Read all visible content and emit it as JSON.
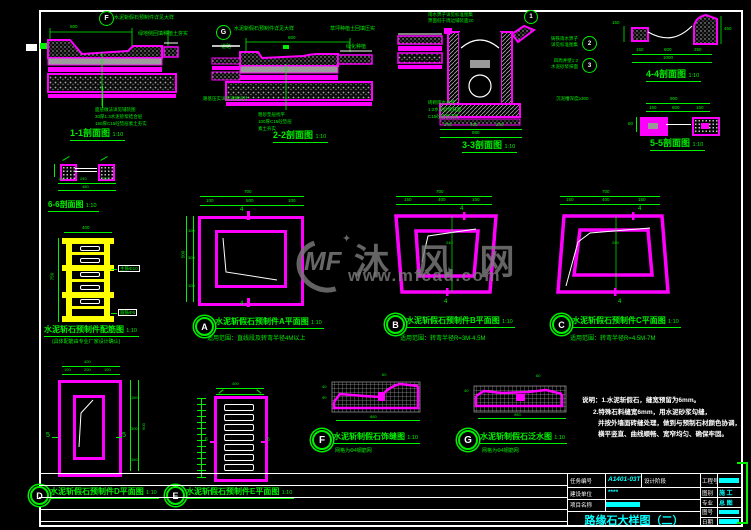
{
  "watermark": {
    "logo": "MF",
    "star": "✦",
    "brand": "沐 风 网",
    "url": "www.mfcad.com"
  },
  "sections": {
    "s11": {
      "title": "1-1剖面图",
      "scale": "1:10",
      "bubble": "F",
      "note_top": "水泥斩假石预制件详见大样",
      "note_right": "绿地侧回填种植土夯实",
      "dim_top": "600",
      "leaders": [
        "面层做法详见铺装图",
        "30厚1:3水泥砂浆结合层",
        "150厚C15砼垫层素土夯实"
      ]
    },
    "s22": {
      "title": "2-2剖面图",
      "scale": "1:10",
      "bubble": "G",
      "note_top": "水泥斩假石预制件详见大样",
      "note_right": "草坪种植土回填压实",
      "tag_left": "道路",
      "tag_right": "绿化种植",
      "note_left": "路基压实详见道路设计",
      "dim_top": "600",
      "leaders": [
        "粗砂垫层找平",
        "100厚C15砼垫层",
        "素土夯实"
      ]
    },
    "s33": {
      "title": "3-3剖面图",
      "scale": "1:10",
      "note_top1": "雨水箅子详见标准图集",
      "note_top2": "箅面低于周边铺装面20",
      "bubble_top": "1",
      "bubbles": [
        {
          "num": "2",
          "line1": "铸铁雨水箅子",
          "line2": "详见标准图集"
        },
        {
          "num": "3",
          "line1": "四周井壁1:2",
          "line2": "水泥砂浆抹面"
        }
      ],
      "leaders": [
        "砖砌雨水井壁",
        "1:2水泥砂浆抹面",
        "C15砼底板浇筑"
      ],
      "note_right": "沉泥槽深度≥300",
      "dims": {
        "segs": [
          "240",
          "400",
          "240"
        ],
        "total": "880"
      }
    },
    "s44": {
      "title": "4-4剖面图",
      "scale": "1:10",
      "dim_left": "150",
      "dim_right": "450",
      "dims": {
        "segs": [
          "150",
          "600",
          "250"
        ],
        "total": "1000"
      }
    },
    "s55": {
      "title": "5-5剖面图",
      "scale": "1:10",
      "dim_left": "60",
      "dims": {
        "total": "900",
        "segs": [
          "150",
          "600",
          "150"
        ]
      }
    },
    "s66": {
      "title": "6-6剖面图",
      "scale": "1:10",
      "dims": {
        "segs": [
          "120",
          "240",
          "120"
        ],
        "total": "480"
      }
    }
  },
  "rebar": {
    "title": "水泥斩石预制件配筋图",
    "scale": "1:10",
    "note": "(具体配筋由专业厂家设计确认)",
    "tag_main": "主筋Φ10",
    "tag_stirrup": "箍筋Φ6",
    "dim_top": "400",
    "dim_left": "750"
  },
  "plans": {
    "A": {
      "letter": "A",
      "title": "水泥斩假石预制件A平面图",
      "scale": "1:10",
      "note": "适用范围：直线段及转弯半径4M以上",
      "marker": "4",
      "dims": {
        "top_total": "700",
        "top_segs": [
          "100",
          "500",
          "100"
        ],
        "left_total": "500",
        "left_segs": [
          "100",
          "300",
          "100"
        ]
      }
    },
    "B": {
      "letter": "B",
      "title": "水泥斩假石预制件B平面图",
      "scale": "1:10",
      "note": "适用范围：转弯半径R=3M-4.5M",
      "marker": "4",
      "dims": {
        "top_total": "700",
        "top_segs": [
          "150",
          "400",
          "150"
        ],
        "mid": "240"
      }
    },
    "C": {
      "letter": "C",
      "title": "水泥斩假石预制件C平面图",
      "scale": "1:10",
      "note": "适用范围：转弯半径R=4.5M-7M",
      "marker": "4",
      "dims": {
        "top_total": "700",
        "top_segs": [
          "150",
          "400",
          "150"
        ],
        "mid": "240"
      }
    },
    "D": {
      "letter": "D",
      "title": "水泥斩假石预制件D平面图",
      "scale": "1:10",
      "marker": "5",
      "dims": {
        "top_total": "400",
        "top_segs": [
          "100",
          "200",
          "100"
        ],
        "right_total": "600",
        "right_segs": [
          "150",
          "300",
          "150"
        ]
      }
    },
    "E": {
      "letter": "E",
      "title": "水泥斩假石预制件E平面图",
      "scale": "1:10",
      "marker": "6",
      "dims": {
        "top_total": "400"
      }
    }
  },
  "details": {
    "F": {
      "letter": "F",
      "title": "水泥斩制假石饰缝图",
      "scale": "1:10",
      "note": "网格为Φ4钢筋网",
      "dim_bottom": "880",
      "dim_left1": "40",
      "dim_left2": "90",
      "dim_top": "60"
    },
    "G": {
      "letter": "G",
      "title": "水泥斩制假石泛水图",
      "scale": "1:10",
      "note": "网格为Φ4钢筋网",
      "dim_bottom": "980",
      "dim_left1": "40",
      "dim_top": "60"
    }
  },
  "notes": {
    "line1": "说明：1.水泥斩假石，缝宽预留为6mm。",
    "line2": "2.特殊石料缝宽6mm，用水泥砂浆勾缝，",
    "line3": "并按外墙面砖缝处理，做到与预制石材颜色协调，",
    "line4": "横平竖直、曲线顺畅、宽窄均匀、确保牢固。"
  },
  "titleblock": {
    "renwu_label": "任务编号",
    "renwu_value": "A1401-03T",
    "jieduan_label": "设计阶段",
    "jianshe_label": "建设单位",
    "jianshe_value": "****",
    "xiangmu_label": "项目名称",
    "gongchenghao_label": "工程号",
    "tubie_label": "图别",
    "tubie_value": "施 工",
    "zhuanye_label": "专业",
    "zhuanye_value": "总 图",
    "tuhao_label": "图号",
    "riqi_label": "日期",
    "title": "路缘石大样图（二）"
  }
}
